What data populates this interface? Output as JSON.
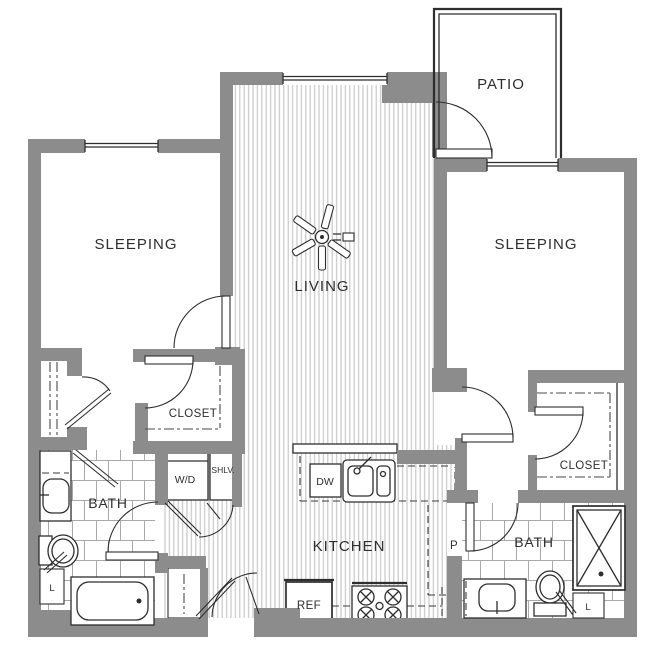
{
  "colors": {
    "wall": "#8c8c8c",
    "line": "#2e2e2e",
    "floor_stripe": "#c4c4c4",
    "tile_line": "#a9a9a9",
    "background": "#ffffff"
  },
  "rooms": {
    "sleeping_left": "SLEEPING",
    "sleeping_right": "SLEEPING",
    "living": "LIVING",
    "patio": "PATIO",
    "kitchen": "KITCHEN",
    "bath_left": "BATH",
    "bath_right": "BATH",
    "closet_left": "CLOSET",
    "closet_right": "CLOSET"
  },
  "fixtures": {
    "washer_dryer": "W/D",
    "shelves": "SHLV.",
    "dishwasher": "DW",
    "refrigerator": "REF",
    "pantry": "P",
    "linen_left": "L",
    "linen_right": "L"
  }
}
